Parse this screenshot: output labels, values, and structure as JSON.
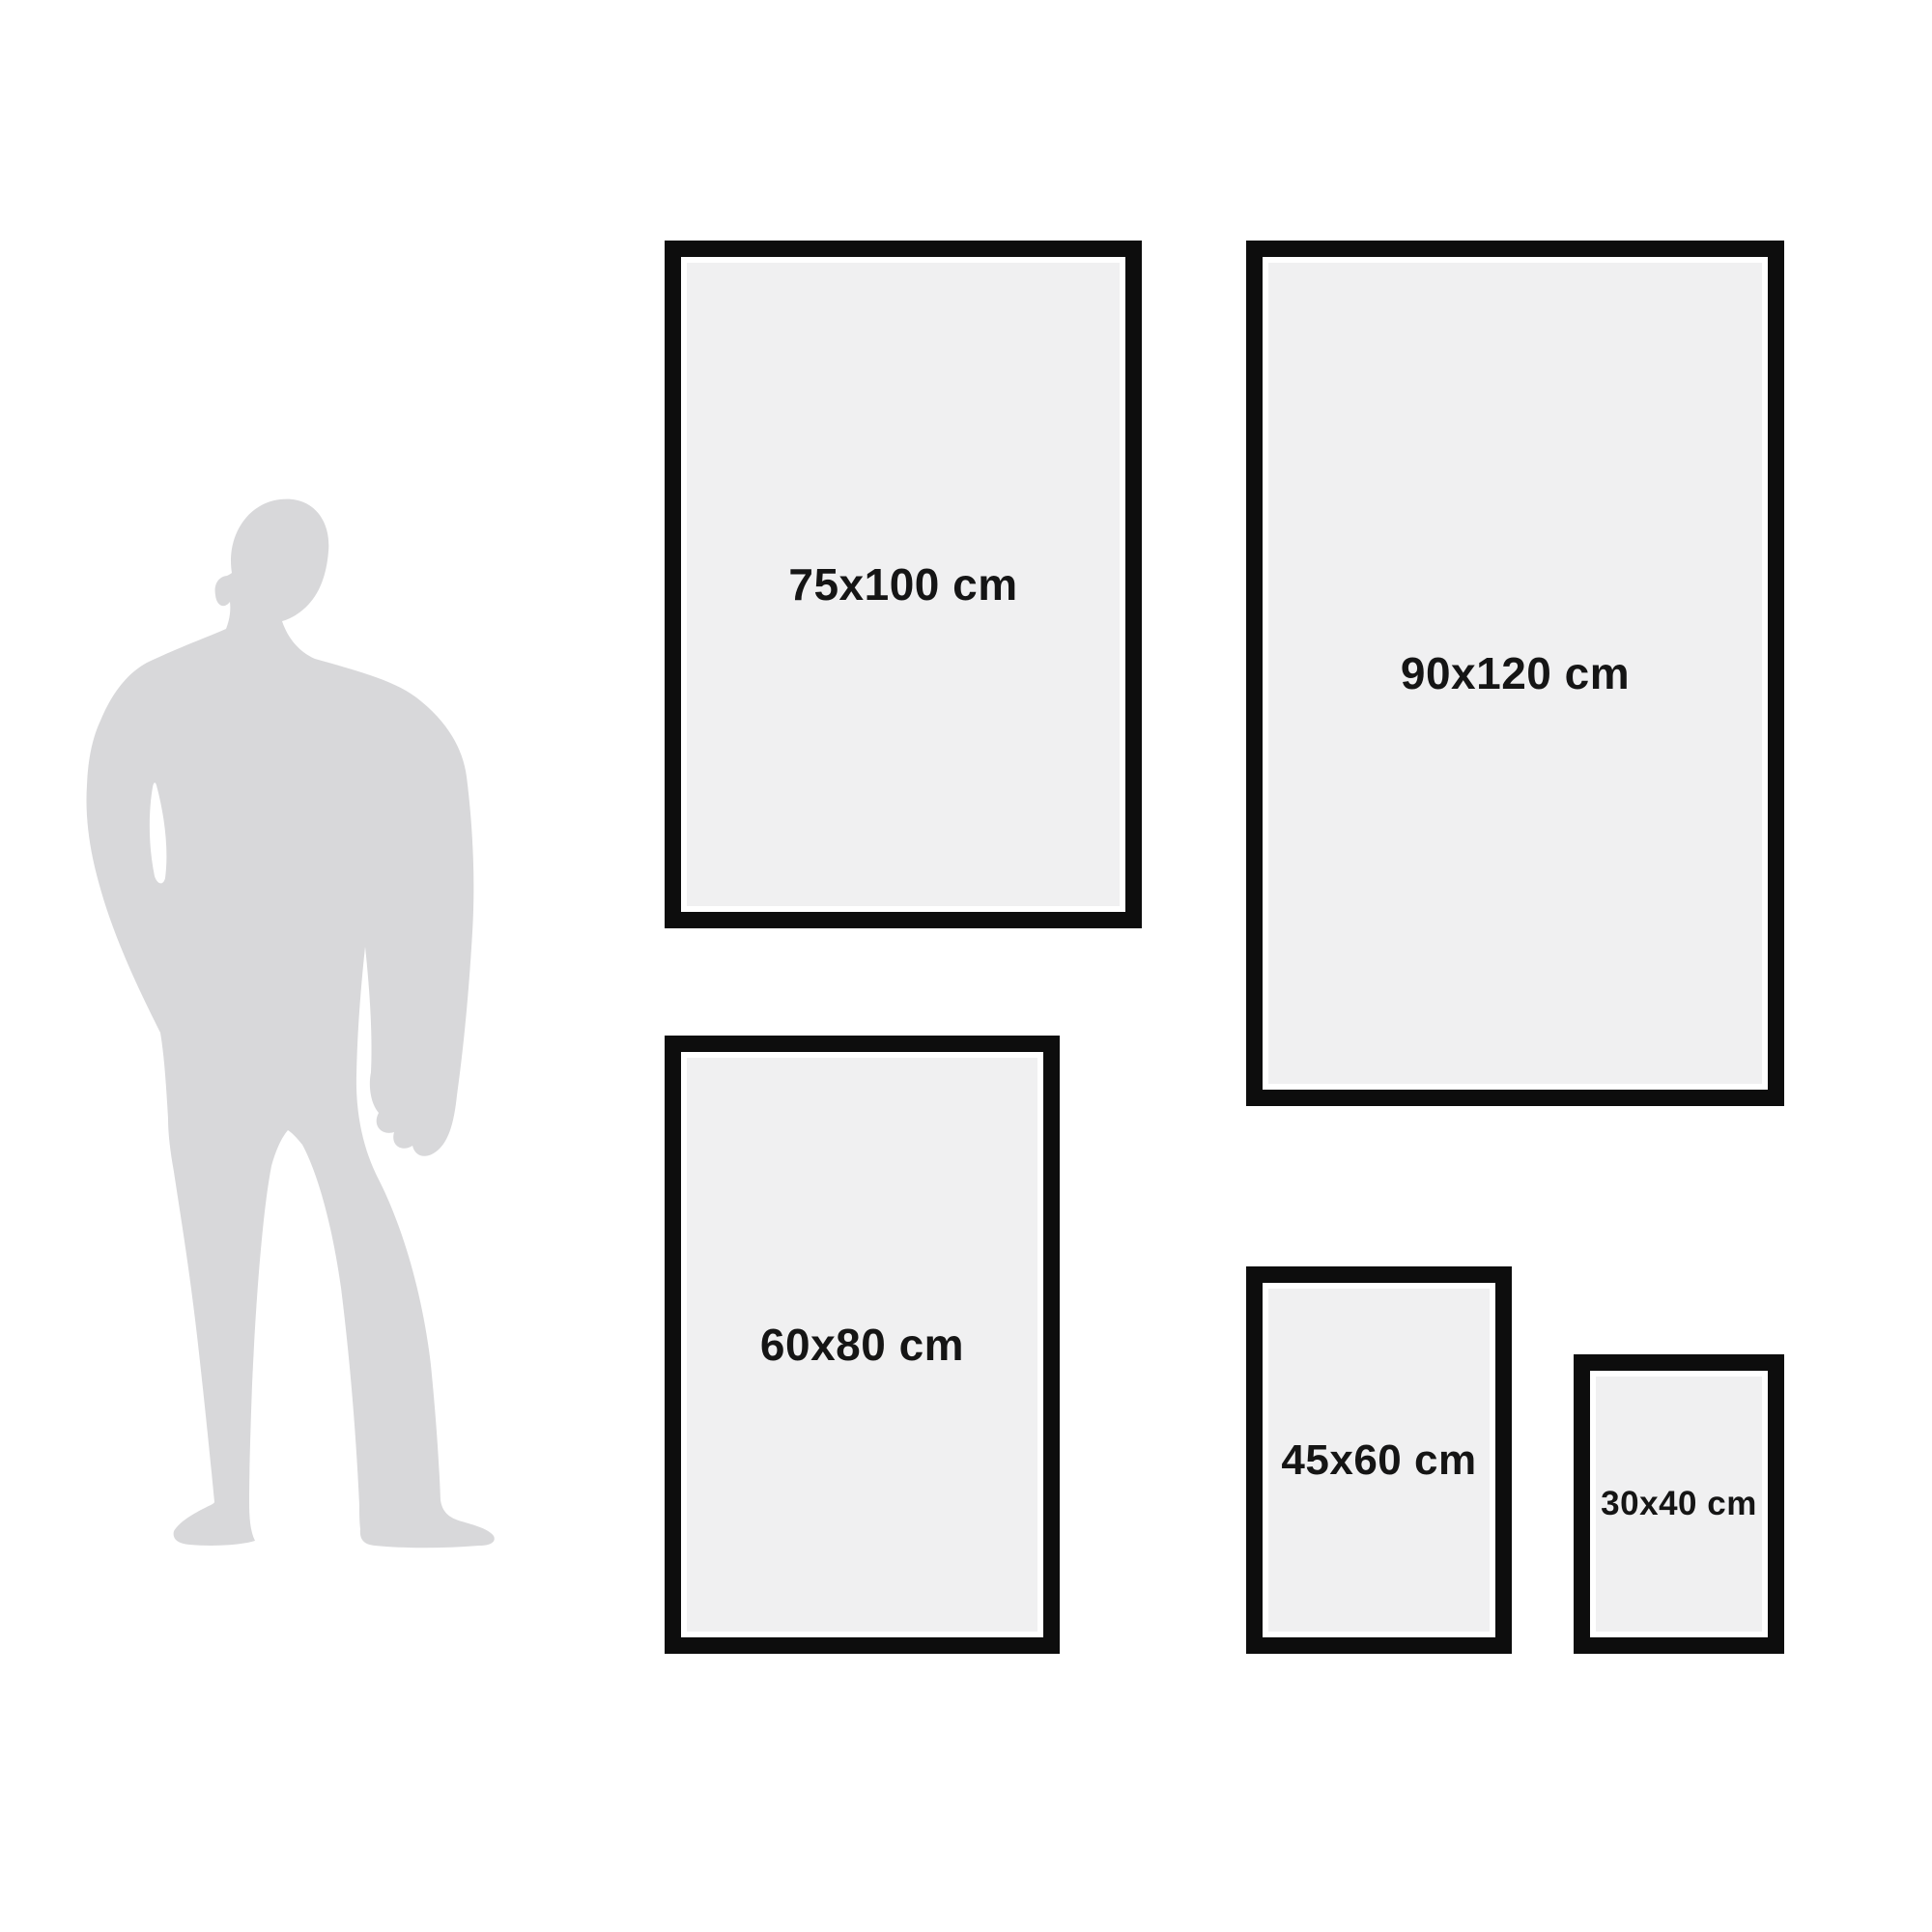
{
  "colors": {
    "background": "#ffffff",
    "frame_border": "#0d0d0d",
    "frame_fill": "#f0f0f1",
    "frame_mat": "#ffffff",
    "silhouette": "#d8d8da",
    "label_text": "#151515"
  },
  "icons": {
    "person_silhouette": "man-standing-silhouette"
  },
  "frames": [
    {
      "size_label": "75x100 cm"
    },
    {
      "size_label": "90x120 cm"
    },
    {
      "size_label": "60x80 cm"
    },
    {
      "size_label": "45x60 cm"
    },
    {
      "size_label": "30x40 cm"
    }
  ]
}
